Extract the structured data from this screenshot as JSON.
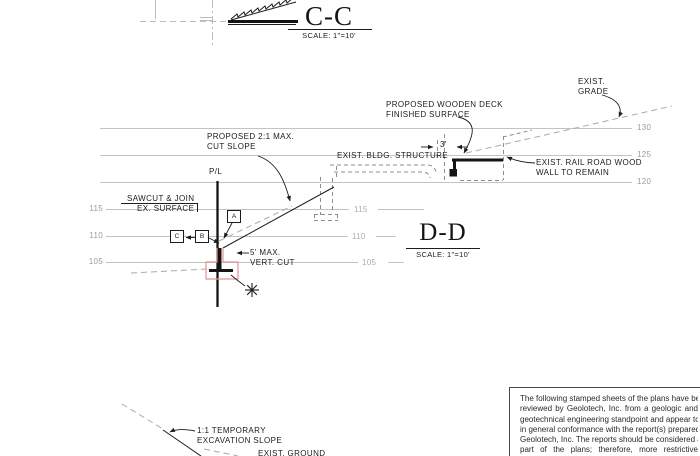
{
  "drawing": {
    "section_cc": {
      "title": "C-C",
      "scale": "SCALE: 1\"=10'"
    },
    "section_dd": {
      "title": "D-D",
      "scale": "SCALE: 1\"=10'"
    },
    "annotations": {
      "exist_grade": [
        "EXIST.",
        "GRADE"
      ],
      "proposed_deck": [
        "PROPOSED WOODEN DECK",
        "FINISHED SURFACE"
      ],
      "exist_bldg": "EXIST. BLDG. STRUCTURE",
      "deck_dim": "3'",
      "rail_wall": [
        "EXIST. RAIL ROAD WOOD",
        "WALL TO REMAIN"
      ],
      "cut_slope": [
        "PROPOSED 2:1 MAX.",
        "CUT SLOPE"
      ],
      "property_line": "P/L",
      "sawcut": [
        "SAWCUT & JOIN",
        "EX. SURFACE"
      ],
      "vert_cut": [
        "5' MAX.",
        "VERT. CUT"
      ],
      "temp_slope": [
        "1:1 TEMPORARY",
        "EXCAVATION SLOPE"
      ],
      "exist_ground": "EXIST. GROUND",
      "callout_a": "A",
      "callout_b": "B",
      "callout_c": "C"
    },
    "elevations": {
      "right": [
        "130",
        "125",
        "120"
      ],
      "left": [
        "115",
        "110",
        "105"
      ],
      "middle": [
        "115",
        "110",
        "105"
      ]
    },
    "colors": {
      "line": "#1c1c1c",
      "grid": "#c3c3c3",
      "gray_label": "#9c9c9c",
      "dashed": "#aaaaaa",
      "highlight_red": "#e39494",
      "paper": "#ffffff"
    }
  },
  "notes": {
    "lines": [
      "The following stamped sheets of the plans have been",
      "reviewed by Geolotech, Inc. from a geologic and",
      "geotechnical engineering standpoint and appear to be",
      "in general conformance with the report(s) prepared by",
      "Geolotech, Inc.  The reports should be considered a",
      "part of the plans; therefore, more restrictive",
      "recommendations within the report(s), as if those are"
    ]
  }
}
